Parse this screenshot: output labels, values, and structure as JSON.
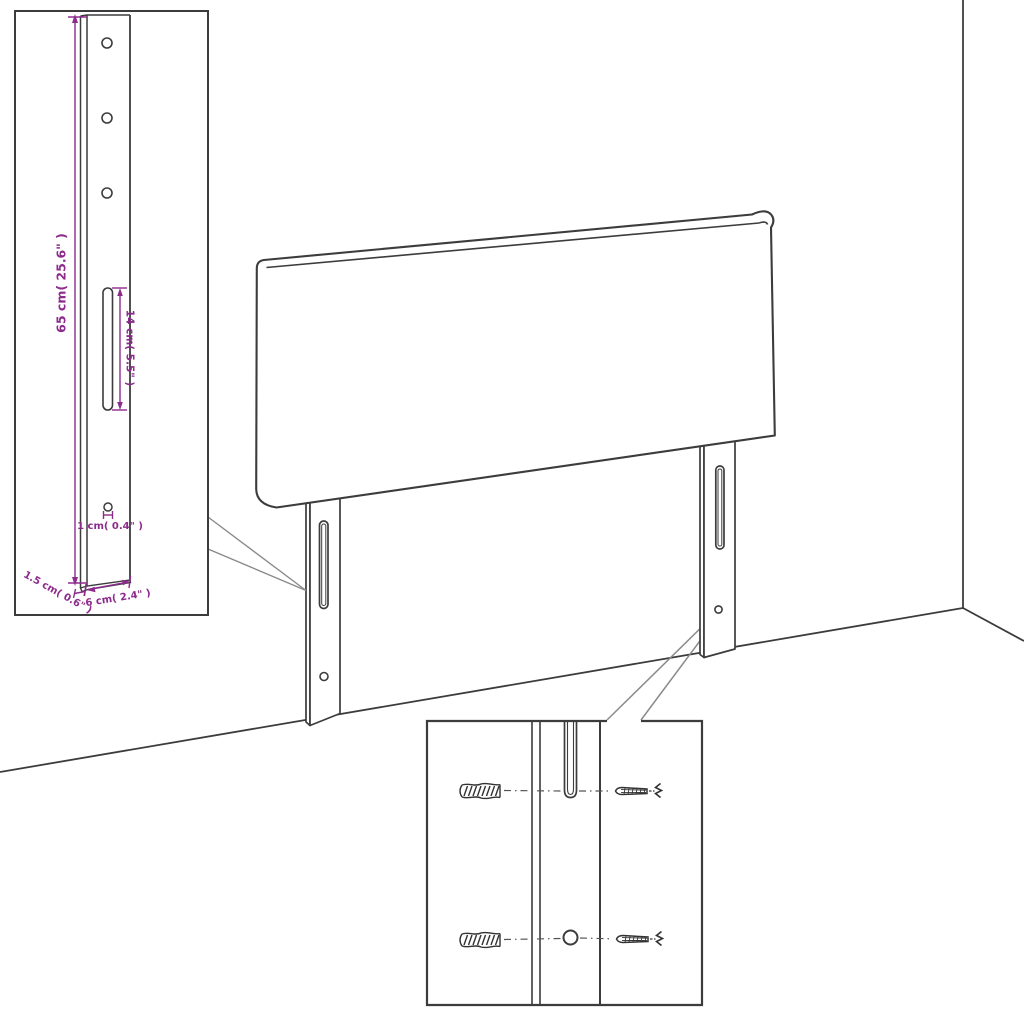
{
  "diagram": {
    "kind": "furniture-assembly-dimension-diagram",
    "subject": "headboard-with-mounting-legs"
  },
  "palette": {
    "line_color": "#3c3c3c",
    "dimension_color": "#8d2b8d",
    "leader_color": "#8a8a8a",
    "background": "#ffffff"
  },
  "bracket_detail": {
    "labels": {
      "height": "65 cm( 25.6\" )",
      "slot": "14 cm( 5.5\" )",
      "hole": "1 cm( 0.4\" )",
      "thickness": "1.5 cm( 0.6\" )",
      "width": "6 cm( 2.4\" )"
    }
  },
  "hardware_detail": {
    "icons": {
      "wall_plug": "wall-plug-icon",
      "screw": "screw-icon"
    }
  }
}
